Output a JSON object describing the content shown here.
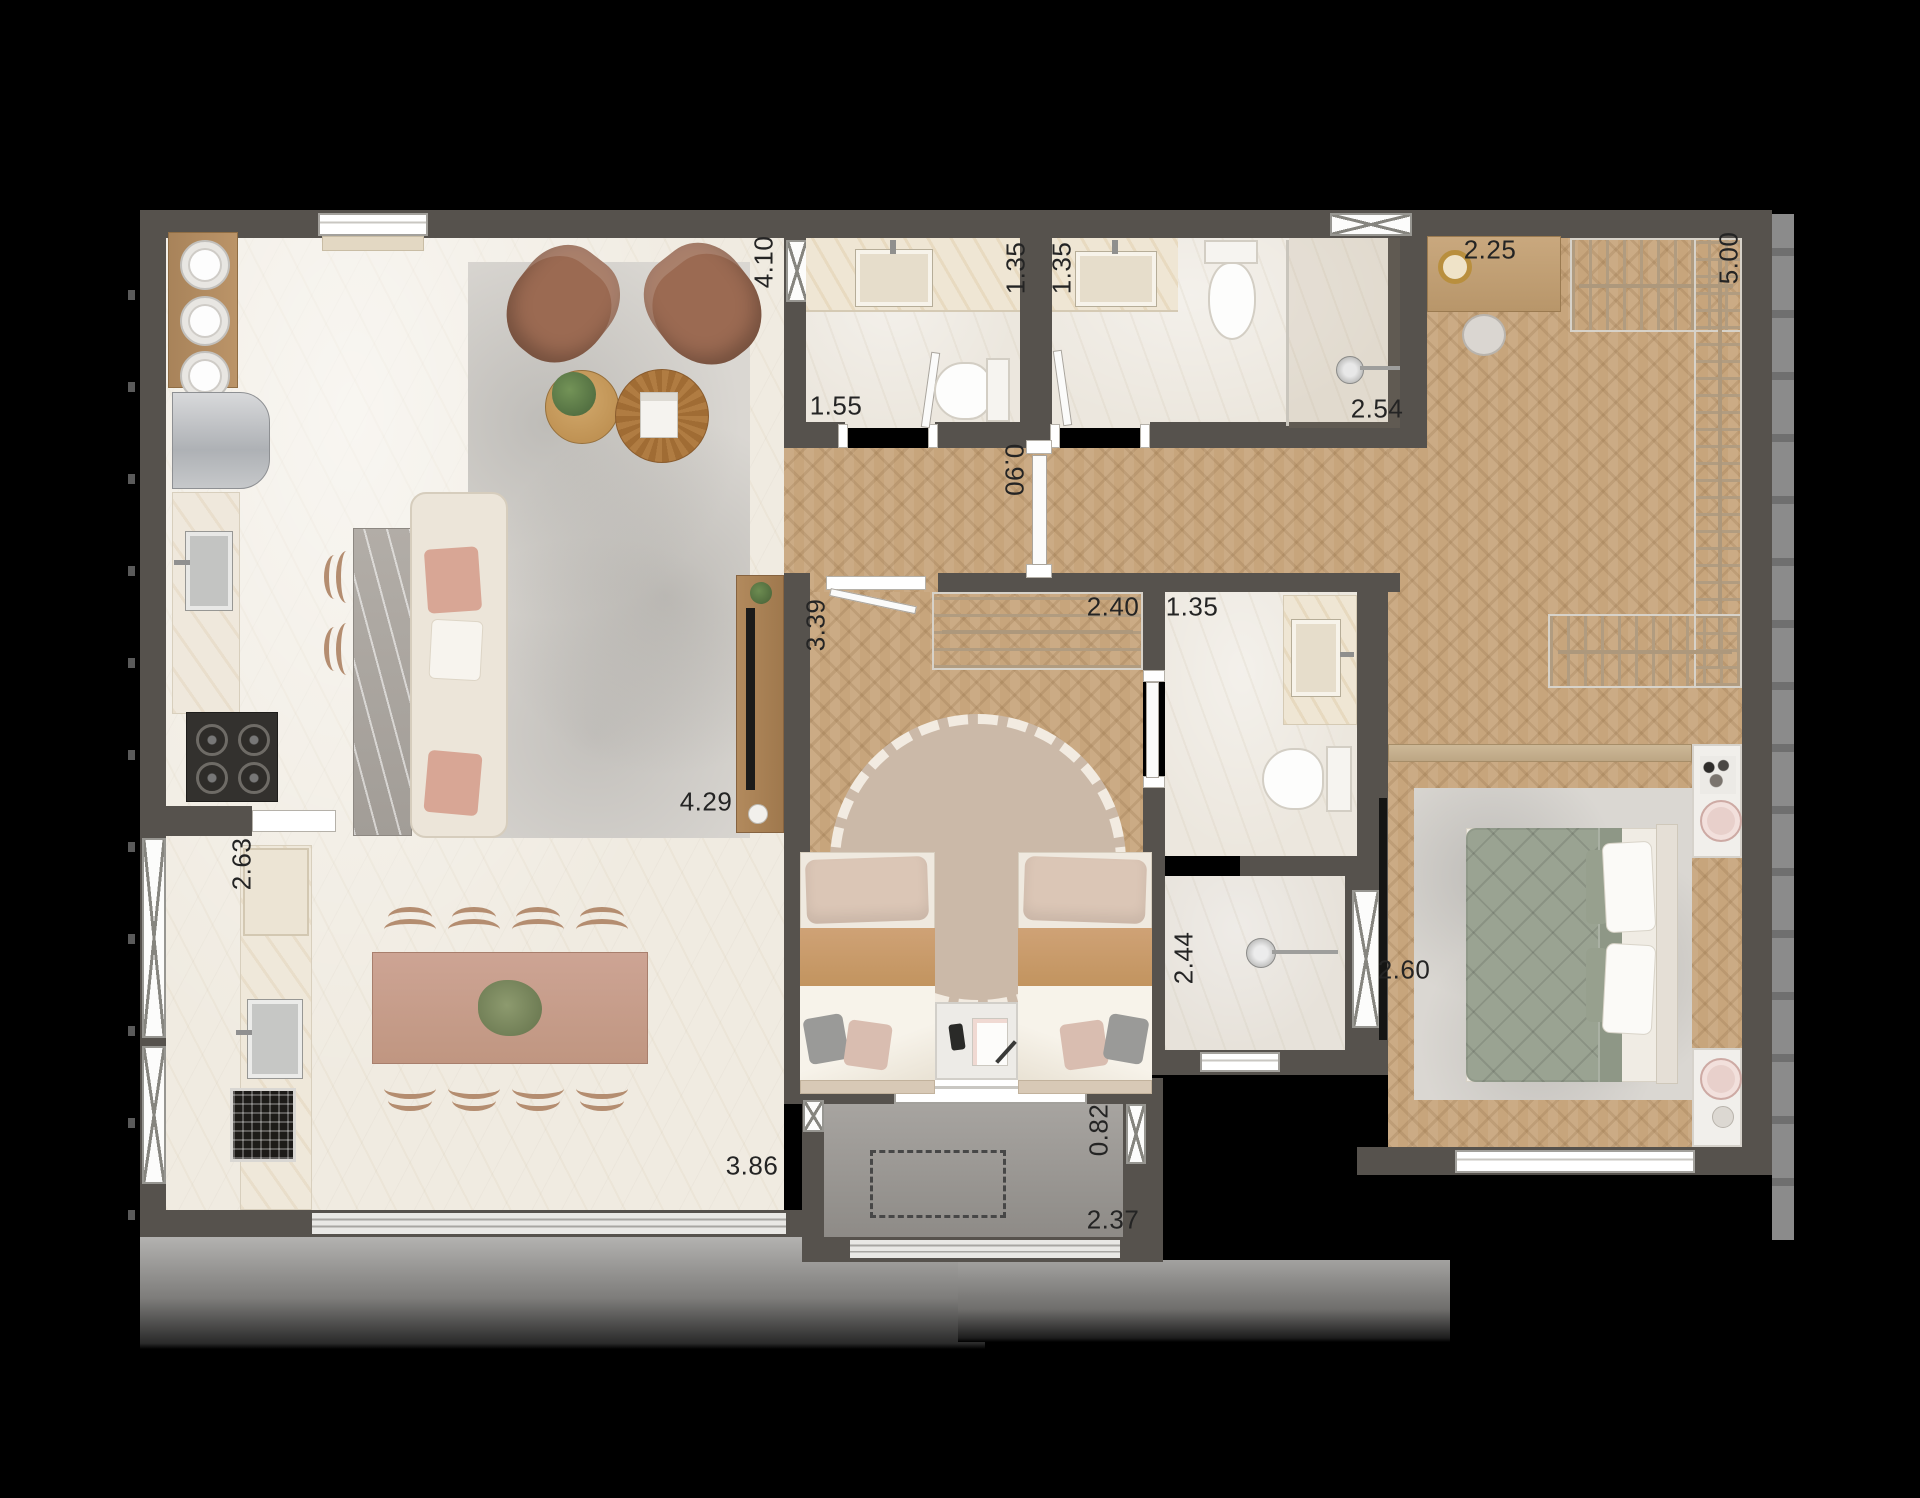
{
  "plan": {
    "title": "apartment-floor-plan",
    "dimensions": [
      {
        "name": "living-length",
        "value": "4.10"
      },
      {
        "name": "bath1-width",
        "value": "1.35"
      },
      {
        "name": "bath2-width",
        "value": "1.35"
      },
      {
        "name": "closet-desk-width",
        "value": "2.25"
      },
      {
        "name": "closet-length",
        "value": "5.00"
      },
      {
        "name": "bath1-length",
        "value": "1.55"
      },
      {
        "name": "bath2-length",
        "value": "2.54"
      },
      {
        "name": "hall-door-width",
        "value": "0.90"
      },
      {
        "name": "bedroom2-length",
        "value": "3.39"
      },
      {
        "name": "bedroom2-wardrobe-width",
        "value": "2.40"
      },
      {
        "name": "bath3-width",
        "value": "1.35"
      },
      {
        "name": "living-width",
        "value": "4.29"
      },
      {
        "name": "service-width",
        "value": "2.63"
      },
      {
        "name": "bath3-length",
        "value": "2.44"
      },
      {
        "name": "master-width",
        "value": "2.60"
      },
      {
        "name": "dining-width",
        "value": "3.86"
      },
      {
        "name": "balcony-depth",
        "value": "0.82"
      },
      {
        "name": "balcony-width",
        "value": "2.37"
      }
    ],
    "colors": {
      "background": "#000000",
      "walls": "#56524d",
      "marble_floor": "#f0ebe1",
      "bathroom_floor": "#ece7de",
      "wood_floor": "#c7a57c",
      "island_marble": "#aca69f",
      "rug_gray": "#dad7d2",
      "rug_round_beige": "#cbb9a8",
      "master_bed_green": "#9aa392",
      "armchair_brown": "#9b6a52",
      "dining_table_wood": "#c9a08b",
      "label_text": "#242424"
    }
  }
}
